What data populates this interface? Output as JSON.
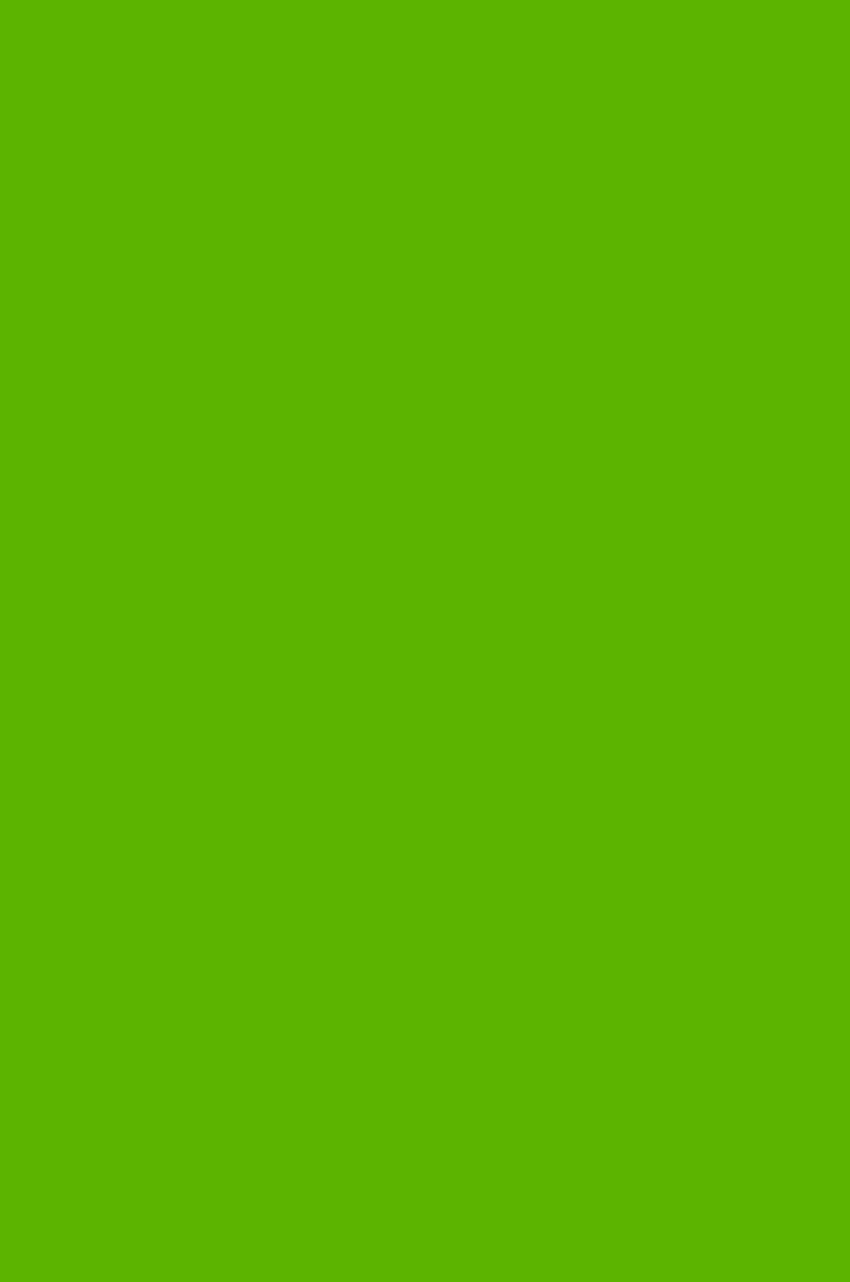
{
  "canvas": {
    "background_color": "#5AB400"
  }
}
